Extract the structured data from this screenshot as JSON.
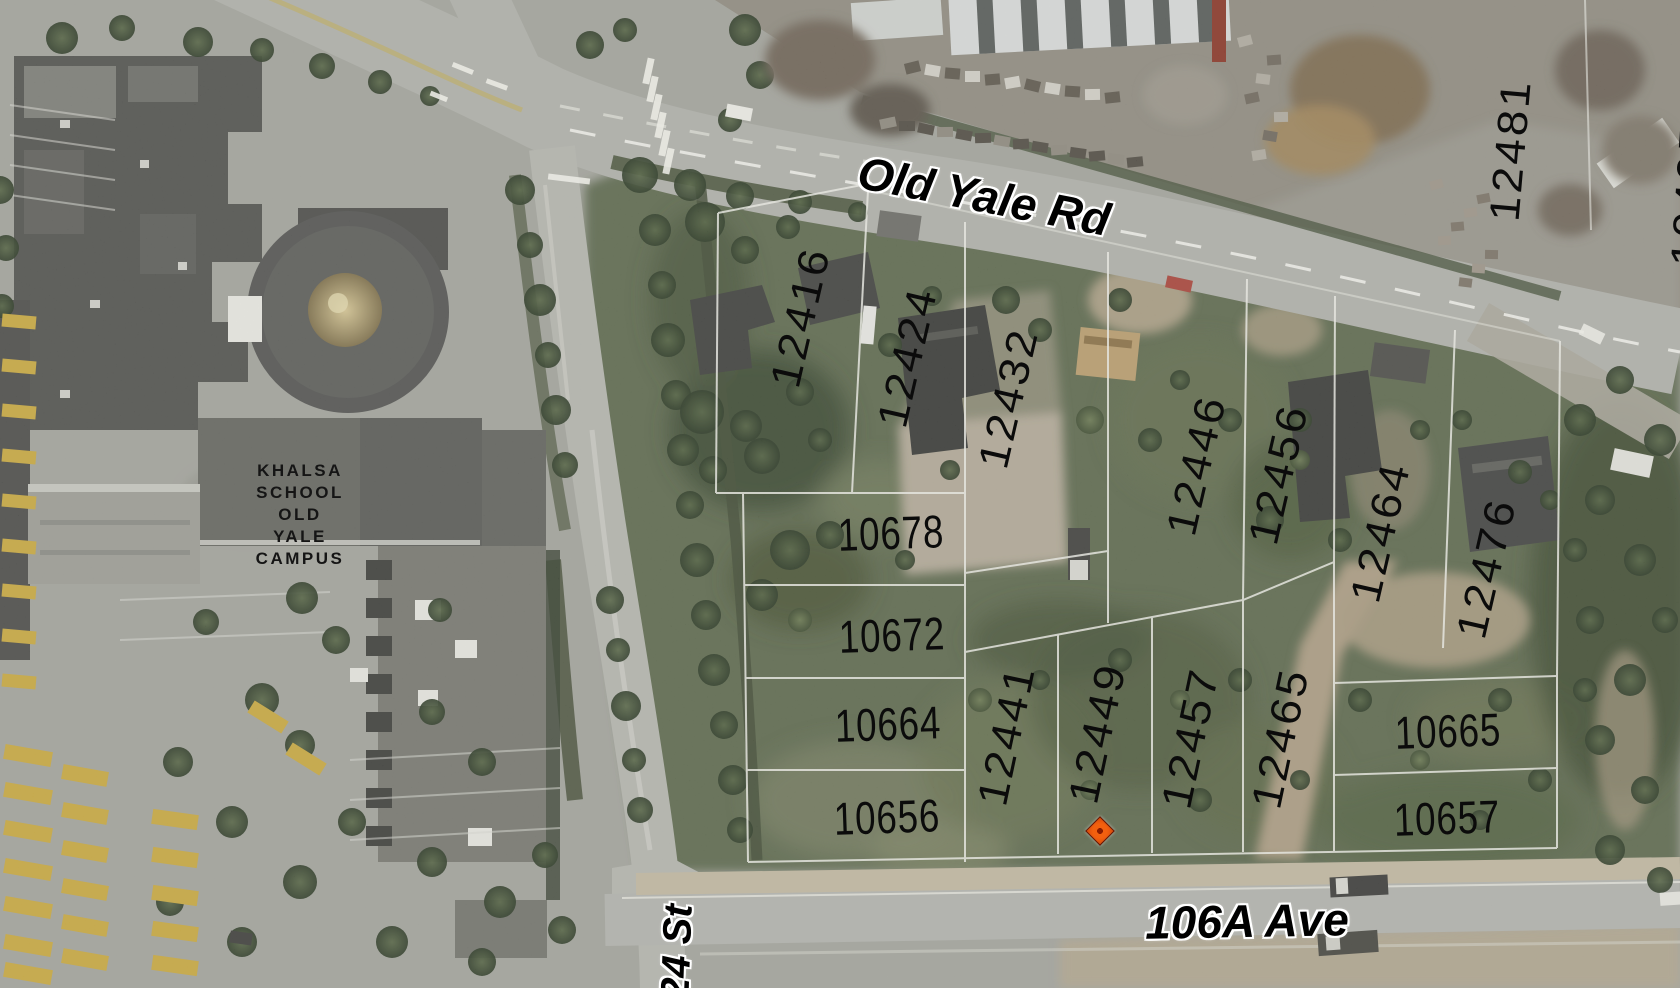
{
  "map": {
    "description": "Aerial parcel map with lot numbers",
    "streets": [
      {
        "name": "Old Yale Rd",
        "x": 984,
        "y": 196,
        "rotate": 11,
        "size": 46
      },
      {
        "name": "106A Ave",
        "x": 1247,
        "y": 921,
        "rotate": -1,
        "size": 46
      },
      {
        "name": "24 St",
        "x": 677,
        "y": 952,
        "rotate": -88,
        "size": 40
      }
    ],
    "campus_label": {
      "lines": [
        "KHALSA",
        "SCHOOL",
        "OLD",
        "YALE",
        "CAMPUS"
      ],
      "x": 300,
      "y": 460
    },
    "parcels": [
      {
        "number": "12416",
        "x": 800,
        "y": 317,
        "rotate": -77
      },
      {
        "number": "12424",
        "x": 907,
        "y": 357,
        "rotate": -77
      },
      {
        "number": "12432",
        "x": 1008,
        "y": 398,
        "rotate": -77
      },
      {
        "number": "12446",
        "x": 1196,
        "y": 465,
        "rotate": -77
      },
      {
        "number": "12456",
        "x": 1278,
        "y": 474,
        "rotate": -77
      },
      {
        "number": "12464",
        "x": 1380,
        "y": 532,
        "rotate": -77
      },
      {
        "number": "12476",
        "x": 1486,
        "y": 568,
        "rotate": -77
      },
      {
        "number": "12481",
        "x": 1510,
        "y": 150,
        "rotate": -85
      },
      {
        "number": "10495",
        "x": 1690,
        "y": 195,
        "rotate": -86,
        "partial": true
      },
      {
        "number": "10678",
        "x": 891,
        "y": 533,
        "rotate": -2,
        "horizontal": true
      },
      {
        "number": "10672",
        "x": 892,
        "y": 635,
        "rotate": -2,
        "horizontal": true
      },
      {
        "number": "10664",
        "x": 888,
        "y": 724,
        "rotate": -2,
        "horizontal": true
      },
      {
        "number": "10656",
        "x": 887,
        "y": 817,
        "rotate": -2,
        "horizontal": true
      },
      {
        "number": "12441",
        "x": 1006,
        "y": 735,
        "rotate": -78
      },
      {
        "number": "12449",
        "x": 1097,
        "y": 733,
        "rotate": -78
      },
      {
        "number": "12457",
        "x": 1190,
        "y": 738,
        "rotate": -78
      },
      {
        "number": "12465",
        "x": 1280,
        "y": 738,
        "rotate": -78
      },
      {
        "number": "10665",
        "x": 1448,
        "y": 731,
        "rotate": -2,
        "horizontal": true
      },
      {
        "number": "10657",
        "x": 1447,
        "y": 818,
        "rotate": -2,
        "horizontal": true
      }
    ],
    "marker": {
      "x": 1100,
      "y": 831,
      "fill": "#f2600f",
      "core": "#8a1c00"
    }
  }
}
